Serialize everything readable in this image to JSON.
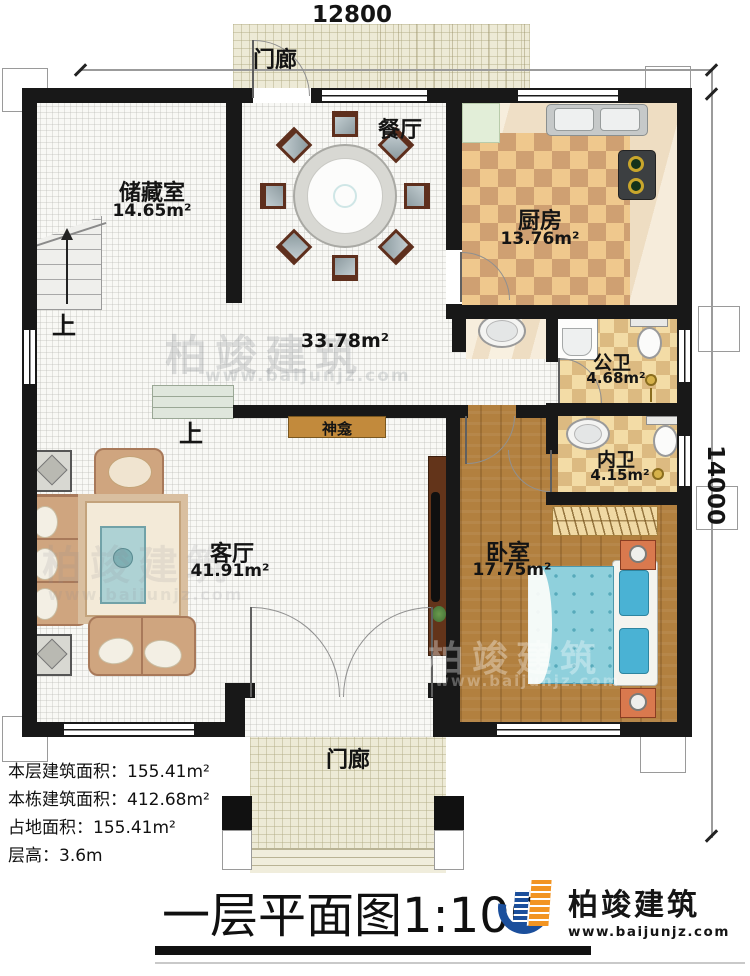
{
  "dimensions": {
    "width": "12800",
    "height": "14000"
  },
  "rooms": {
    "porch_top": {
      "label": "门廊"
    },
    "storage": {
      "label": "储藏室",
      "area": "14.65m²"
    },
    "dining": {
      "label": "餐厅"
    },
    "kitchen": {
      "label": "厨房",
      "area": "13.76m²"
    },
    "hall": {
      "area": "33.78m²"
    },
    "public_bath": {
      "label": "公卫",
      "area": "4.68m²"
    },
    "ensuite_bath": {
      "label": "内卫",
      "area": "4.15m²"
    },
    "bedroom": {
      "label": "卧室",
      "area": "17.75m²"
    },
    "living": {
      "label": "客厅",
      "area": "41.91m²"
    },
    "shrine": {
      "label": "神龛"
    },
    "porch_bottom": {
      "label": "门廊"
    }
  },
  "stairs": {
    "up_label": "上"
  },
  "info": {
    "floor_area_label": "本层建筑面积：",
    "floor_area_value": "155.41m²",
    "building_area_label": "本栋建筑面积：",
    "building_area_value": "412.68m²",
    "footprint_label": "占地面积：",
    "footprint_value": "155.41m²",
    "storey_height_label": "层高：",
    "storey_height_value": "3.6m"
  },
  "title": {
    "text": "一层平面图",
    "scale": "1:100"
  },
  "brand": {
    "name": "柏竣建筑",
    "url": "www.baijunjz.com"
  },
  "watermark": {
    "name": "柏竣建筑",
    "url": "www.baijunjz.com"
  },
  "colors": {
    "wall": "#181818",
    "wood_floor": "#b2803f",
    "porch_floor": "#edead6",
    "kitchen_check_light": "#efc88d",
    "kitchen_check_dark": "#cfa072",
    "bath_check_light": "#f3dca6",
    "bath_check_dark": "#dcba81",
    "bed_mattress": "#8fd0dc",
    "bed_pillow": "#4ab2d4",
    "brand_blue": "#1b4f9c",
    "brand_orange": "#f29422",
    "shrine": "#c28a3c"
  }
}
